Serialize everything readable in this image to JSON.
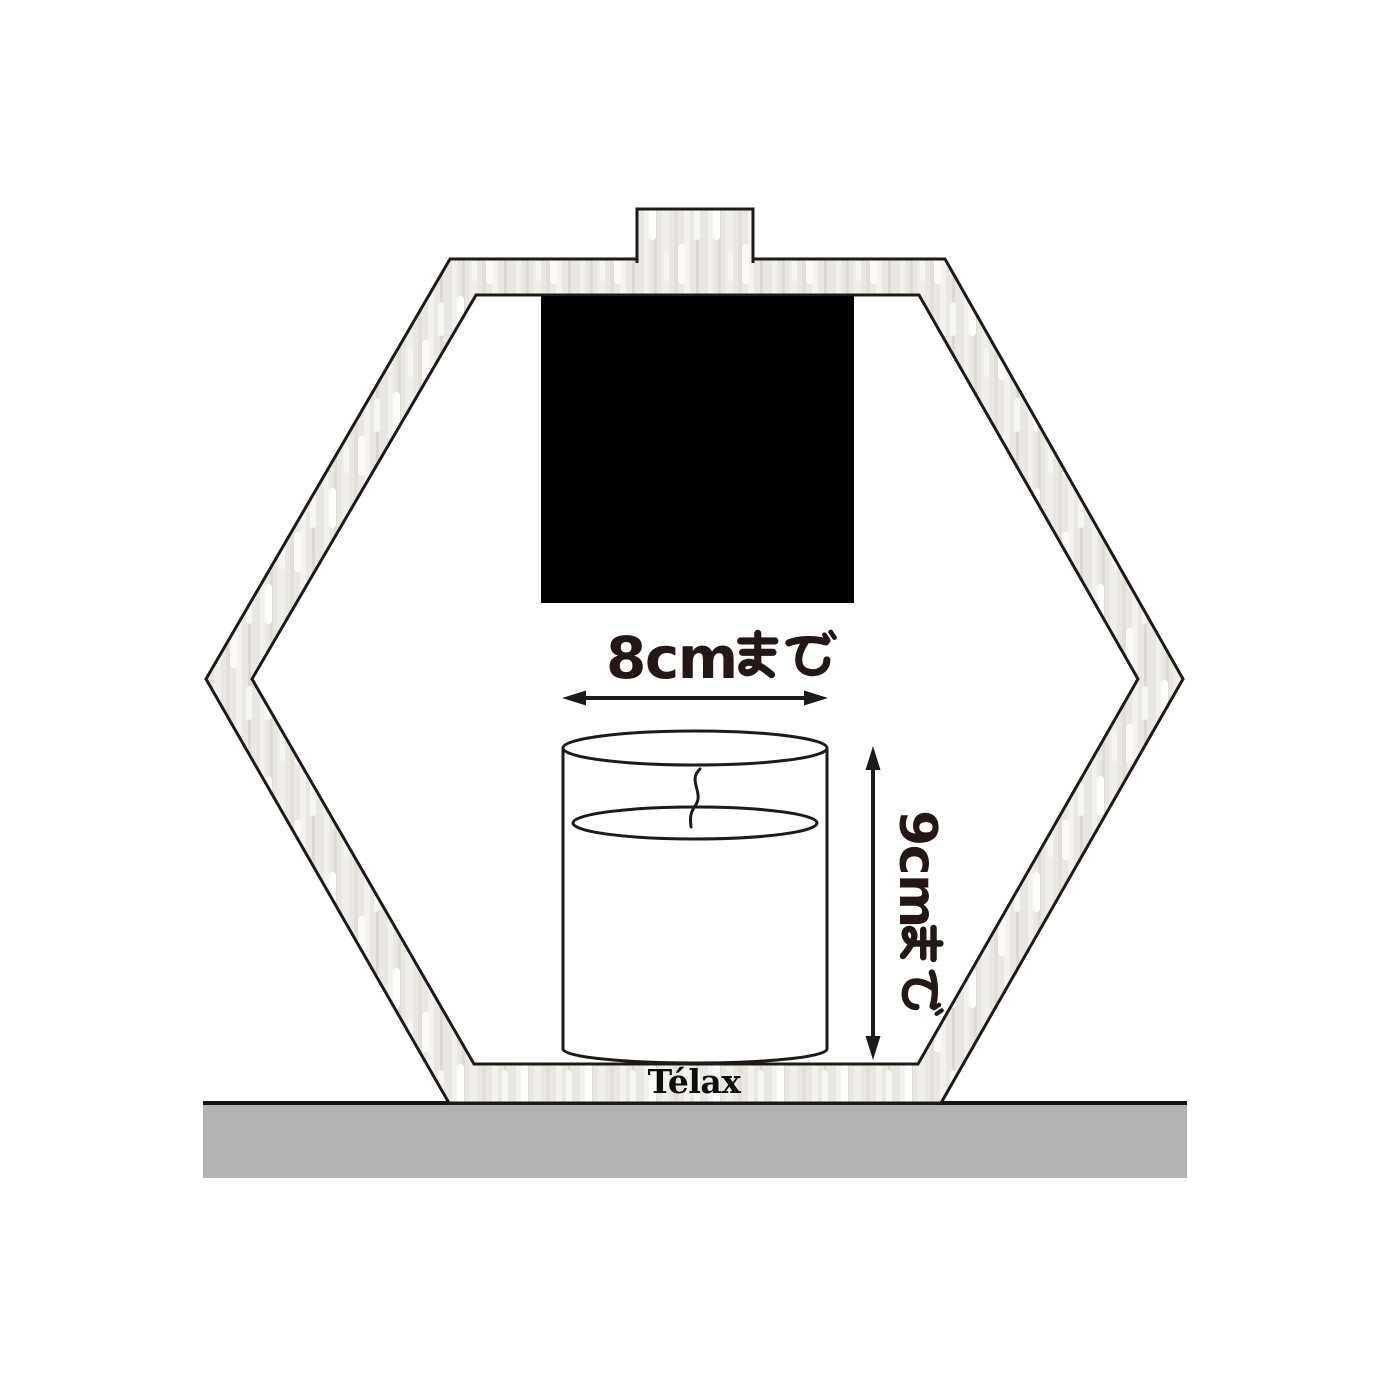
{
  "diagram": {
    "brand": "Télax",
    "labels": {
      "width_limit": "8cmまで",
      "width_value": "8cm",
      "width_suffix": "まで",
      "height_limit": "9cmまで",
      "height_value": "9cm",
      "height_suffix": "まで"
    },
    "colors": {
      "background": "#ffffff",
      "frame_wood": "#ebe8e3",
      "outline": "#1d1b19",
      "black_panel": "#000000",
      "dimension_text": "#231815",
      "ground": "#b2b2b2"
    }
  }
}
